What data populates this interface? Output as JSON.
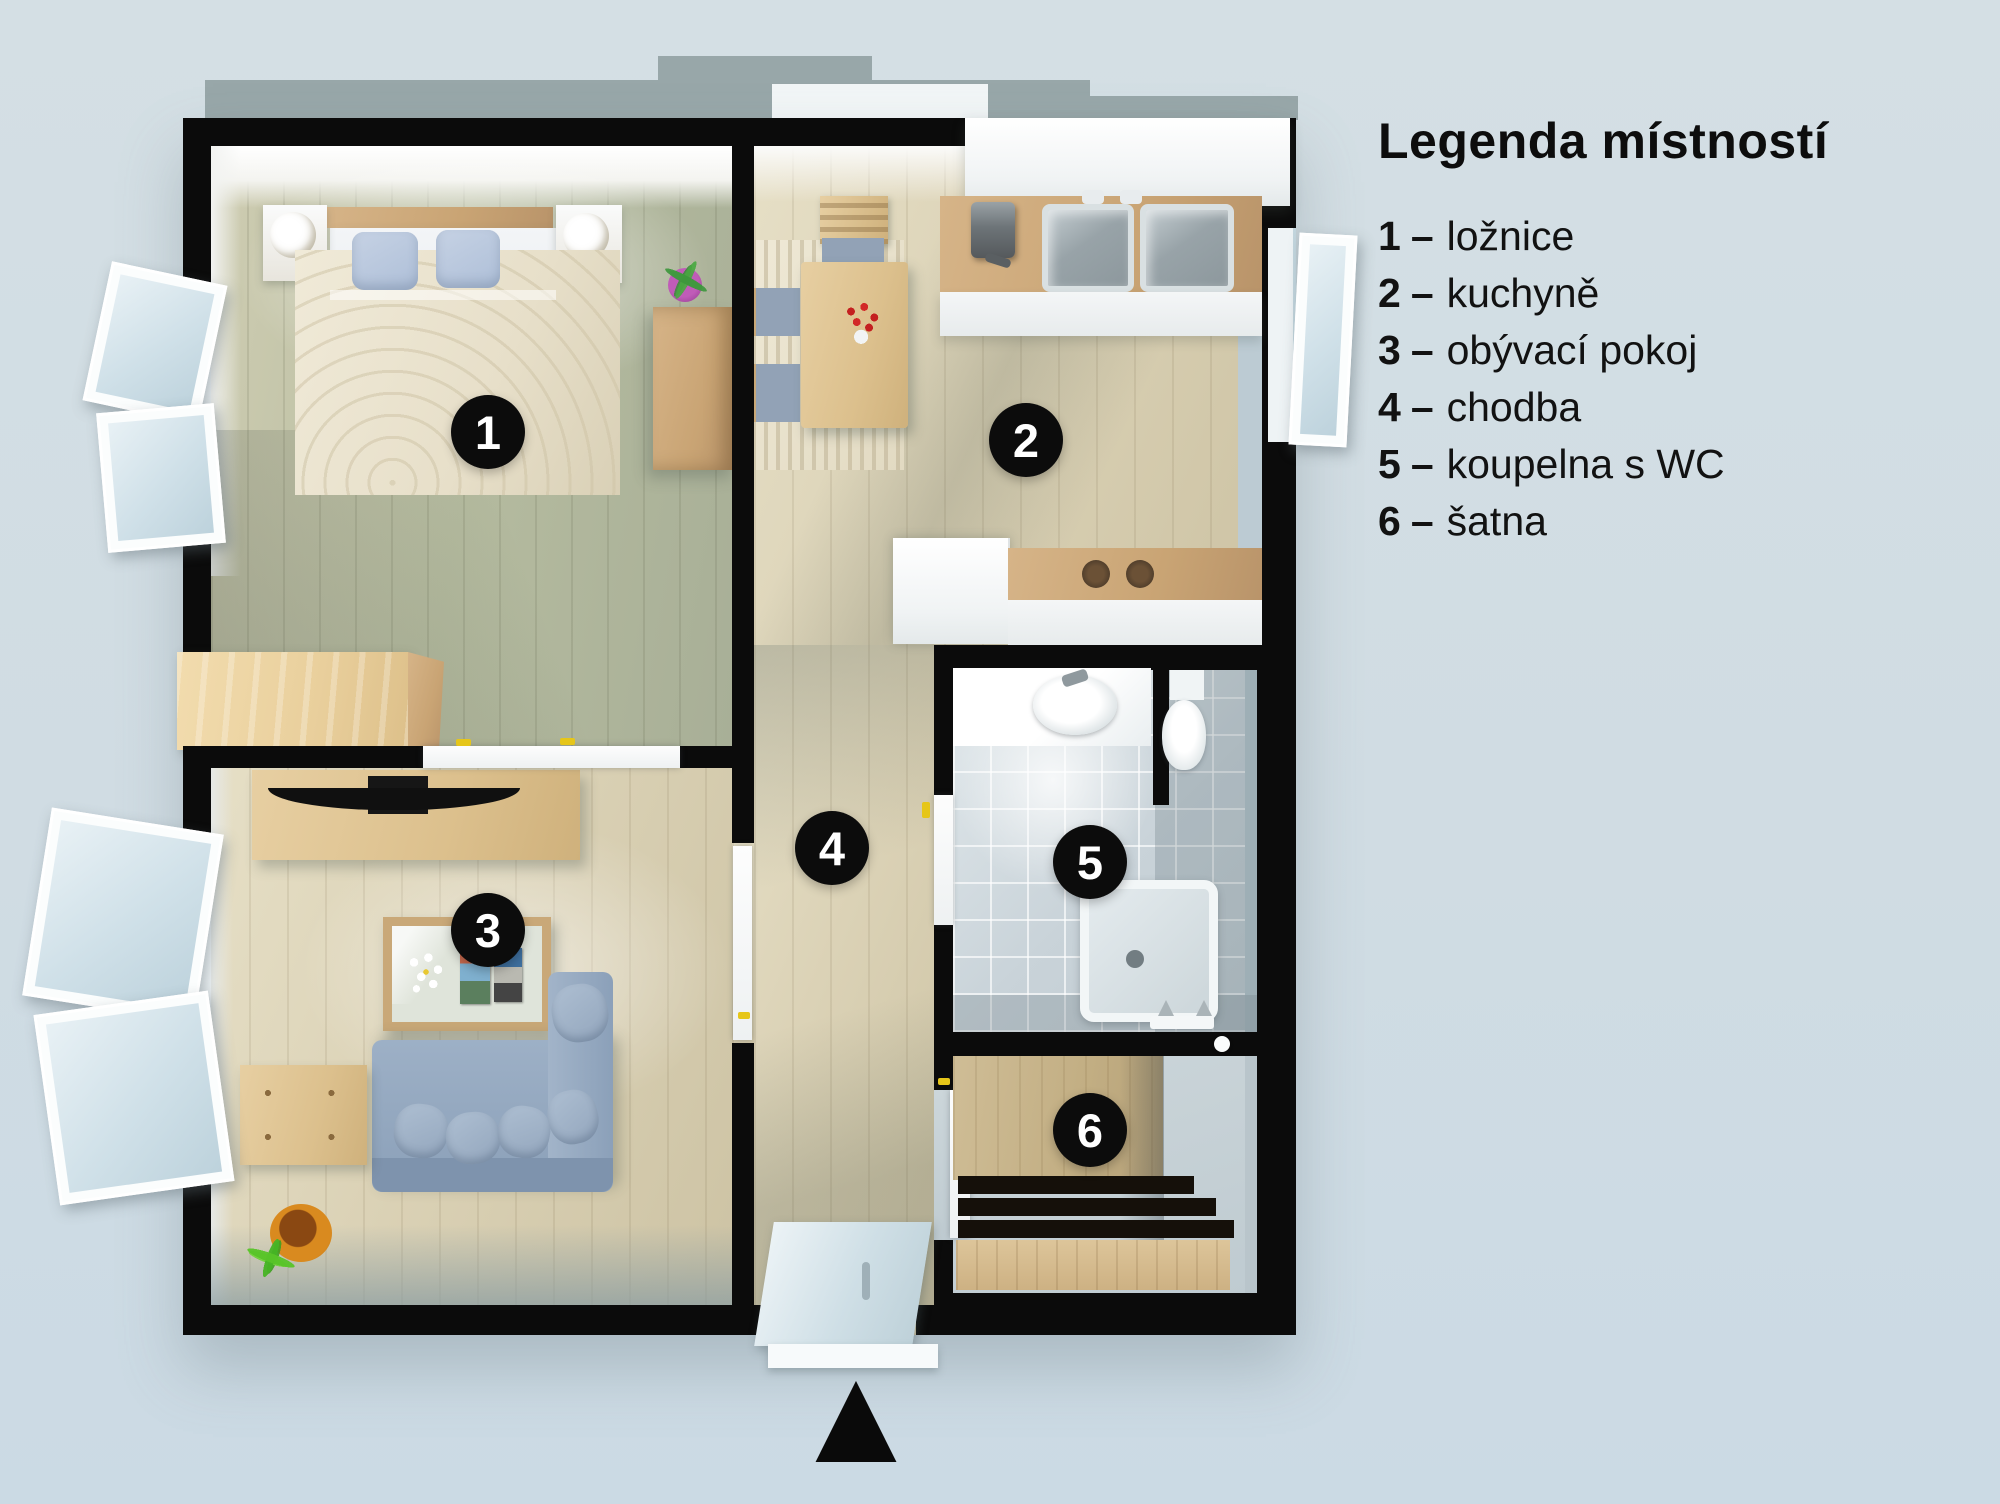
{
  "legend": {
    "title": "Legenda místností",
    "separator": "–"
  },
  "rooms": [
    {
      "num": "1",
      "label": "ložnice"
    },
    {
      "num": "2",
      "label": "kuchyně"
    },
    {
      "num": "3",
      "label": "obývací pokoj"
    },
    {
      "num": "4",
      "label": "chodba"
    },
    {
      "num": "5",
      "label": "koupelna s WC"
    },
    {
      "num": "6",
      "label": "šatna"
    }
  ],
  "entrance": {
    "arrow_icon": "▲"
  },
  "colors": {
    "background": "#d2dde3",
    "backdrop_shadow": "#98a7a9",
    "wall_black": "#0b0b0b",
    "floor_wood": "#d8cfb4",
    "floor_bedroom": "#b2b89c",
    "tile": "#c9d3d9",
    "wood_furniture": "#d0ae7e",
    "bed_blue": "#aebfd8",
    "sofa_blue": "#93a6bd",
    "plant_green": "#58c428",
    "handle_yellow": "#e6c619",
    "badge_black": "#0c0c0c",
    "text_black": "#0d0d0d"
  }
}
